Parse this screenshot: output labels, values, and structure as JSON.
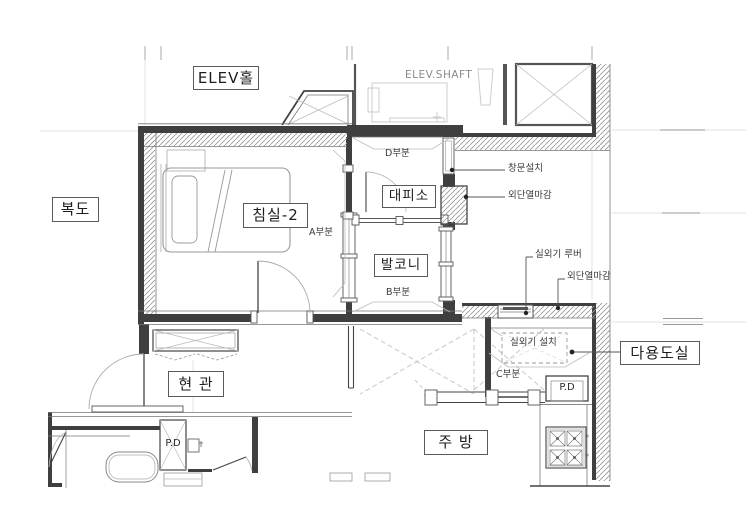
{
  "title": "apartment unit floor plan",
  "rooms": {
    "elev_hall": {
      "label": "ELEV홀"
    },
    "elev_shaft": {
      "label": "ELEV.SHAFT"
    },
    "corridor": {
      "label": "복도"
    },
    "bedroom2": {
      "label": "침실-2"
    },
    "shelter": {
      "label": "대피소"
    },
    "balcony": {
      "label": "발코니"
    },
    "entrance": {
      "label": "현 관"
    },
    "kitchen": {
      "label": "주 방"
    },
    "utility_room": {
      "label": "다용도실"
    }
  },
  "section_marks": {
    "a": {
      "label": "A부분"
    },
    "b": {
      "label": "B부분"
    },
    "c": {
      "label": "C부분"
    },
    "d": {
      "label": "D부분"
    }
  },
  "annotations": {
    "window_install": {
      "label": "창문설치"
    },
    "exterior_insulation_finish_top": {
      "label": "외단열마감"
    },
    "outdoor_unit_louver": {
      "label": "실외기 루버"
    },
    "exterior_insulation_finish_mid": {
      "label": "외단열마감"
    },
    "outdoor_unit_install": {
      "label": "실외기 설치"
    },
    "pipe_duct_utility": {
      "label": "P.D"
    },
    "pipe_duct_bathroom": {
      "label": "P.D"
    }
  },
  "colors": {
    "wall": "#3f3f3f",
    "line_medium": "#6f6f6f",
    "line_light": "#b5b5b5",
    "hatch": "#9a9a9a",
    "label_border": "#5a5a5a",
    "label_text": "#1e1e1e",
    "annotation_text": "#3a3a3a",
    "gray_text": "#8a8a8a"
  }
}
